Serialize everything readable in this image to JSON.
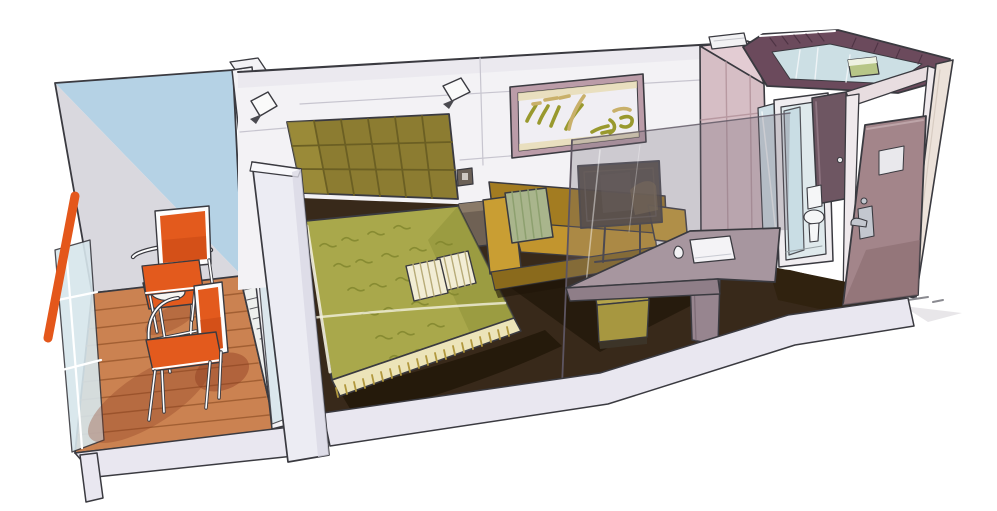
{
  "scene": {
    "kind": "cruise-ship-balcony-cabin-cutaway-illustration",
    "background": "#ffffff"
  },
  "palette": {
    "ink": "#3a3a40",
    "paper": "#ffffff",
    "wall": "#f3f2f5",
    "wall_shade": "#e4e2ea",
    "seam": "#c7c5cf",
    "sky": "#b5d2e5",
    "wall_gray": "#d9d8de",
    "deck": "#cb8251",
    "deck_line": "#9b5a2e",
    "vent": "#eef0ee",
    "rail": "#e4571b",
    "chair": "#e35a1d",
    "chair_dark": "#c04514",
    "shadow_warm": "#8c3a1e",
    "tray": "#f6f5f1",
    "glass_pale": "#d7e6ec",
    "curtain": "#c9a84e",
    "curtain_fold": "#a08238",
    "pillar": "#ececf3",
    "pillar_top": "#f8f8fb",
    "pillar_shade": "#dbd9e5",
    "cut_band": "#e9e7f0",
    "headboard": "#8c7c31",
    "headboard_line": "#6b5f23",
    "headboard_light": "#a3953e",
    "bed_green": "#a9a84b",
    "bed_green_dark": "#8e9038",
    "bed_pattern": "#82862e",
    "bed_highlight": "#f3f0dd",
    "skirt": "#ece4b9",
    "skirt_tick": "#b1983e",
    "pillow": "#f2edd5",
    "pillow_stripe": "#b7ab78",
    "carpet": "#38291a",
    "carpet_dark": "#201608",
    "carpet_light": "#4b3722",
    "gold": "#d4b23c",
    "sofa": "#c2952e",
    "sofa_light": "#c99e33",
    "sofa_dark": "#a37c21",
    "sofa_base": "#8a6a1c",
    "sage": "#a9b58c",
    "sage_stripe": "#8da06f",
    "tv": "#4a423c",
    "tv_edge": "#2a2420",
    "tv_inner": "#5f564e",
    "tv_reflect": "#7c6c4e",
    "glass_tint": "rgba(120,108,122,0.30)",
    "pane_edge": "#5d5561",
    "desk": "#a7969f",
    "desk_front": "#8f7e88",
    "desk_support": "#97858f",
    "desk_line": "#7c6b75",
    "stool": "#b5a44b",
    "stool_front": "#a79740",
    "stool_base": "#3c3428",
    "notepad": "#f4f3f6",
    "notepad_line": "#c9cbd3",
    "closet": "#d6bec5",
    "closet_top": "#e3ccd3",
    "closet_line": "#b899a1",
    "mirror": "#cfdfe6",
    "mirror_frame": "#f6f6f8",
    "bath_frame": "#f0edf0",
    "bath_wall": "#dfe9ec",
    "shower": "#c6dbe3",
    "porcelain": "#f5f6f7",
    "porcelain_line": "#9aa4a8",
    "bath_door": "#6e5662",
    "bath_door_edge": "#8d7480",
    "plum": "#6b4a5c",
    "plum_dark": "#4e3344",
    "plum_floor": "#ccdfe4",
    "towel": "#b7c687",
    "towel_top": "#eef2e2",
    "ventbox": "#f2f2f4",
    "ventbox_line": "#c6c6cc",
    "door": "#a3858a",
    "door_shade": "#8d6f74",
    "door_hi": "#bda4a8",
    "door_window": "#e9e8ec",
    "door_window_line": "#c9ccd2",
    "metal": "#c3c7cf",
    "metal_dark": "#6a6e78",
    "jamb": "#efe9ec",
    "lintel": "#e8dde0",
    "outer_wall": "#ece2da",
    "outer_line": "#d8ccc2",
    "vestibule": "#30220f",
    "dash": "#8a8a90",
    "shadow_gray": "#d8d6da",
    "white": "#ffffff",
    "frame_mauve": "#bb9ca8",
    "art_mat": "#f0eef3",
    "art_wash": "#e6d9a8",
    "art_olive": "#99992e",
    "art_tan": "#c9b06a",
    "nightstand": "#6f6154",
    "nightstand_top": "#8a7a68",
    "switch": "#6b6157",
    "switch_inner": "#cfc9c2"
  }
}
